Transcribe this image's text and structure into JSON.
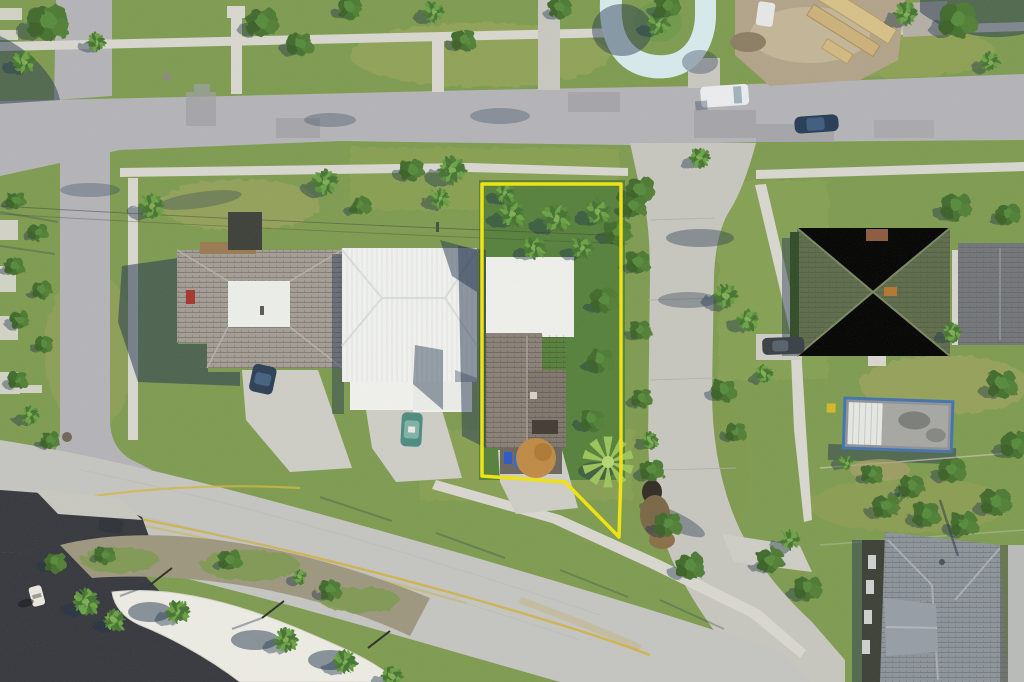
{
  "photo": {
    "kind": "aerial drone photograph",
    "subject": "residential lot highlighted with a yellow boundary overlay"
  },
  "colors": {
    "property_outline": "#f2e50e",
    "grass": "#7e9c4f",
    "grass_dark_lot": "#55803a",
    "asphalt_street": "#b5b5b9",
    "boulevard": "#c6c6c2",
    "side_street_concrete": "#c8c8c0",
    "sidewalk": "#dad9d1",
    "dark_parking_lot": "#34363c",
    "white_metal_roof": "#f3f4f0",
    "gray_shingle_roof": "#a39d96",
    "subject_shingle_roof": "#8a8178",
    "green_shingle_roof": "#5d6b4a",
    "blue_gray_roof": "#8d949b",
    "white_canopy_roof": "#efeee6",
    "lumber_stack": "#d9c289",
    "dirt_construction": "#b3a489",
    "blue_loop_driveway": "#d9ecee",
    "shadow_navy": "#22344e",
    "center_line_yellow": "#d2b13c"
  },
  "scene": {
    "property_outline": "yellow boundary around listed lot",
    "subject_house": "white flat roof + gray shingle gable inside outline",
    "left_house": "gray shingle roof with white skylight",
    "white_metal_house": "white standing-seam metal roof",
    "green_house": "green cross-hip shingle roof",
    "trailer": "mobile home with blue trim",
    "bottom_right_building": "large blue-gray shingle roof",
    "white_canopy": "curved white canopy with palms",
    "construction_site": "lumber stacks on dirt",
    "blue_u_driveway": "painted light-blue loop driveway",
    "vehicles": "white van, dark blue car, navy car, teal car, dark sedan, SUV, golf cart"
  }
}
